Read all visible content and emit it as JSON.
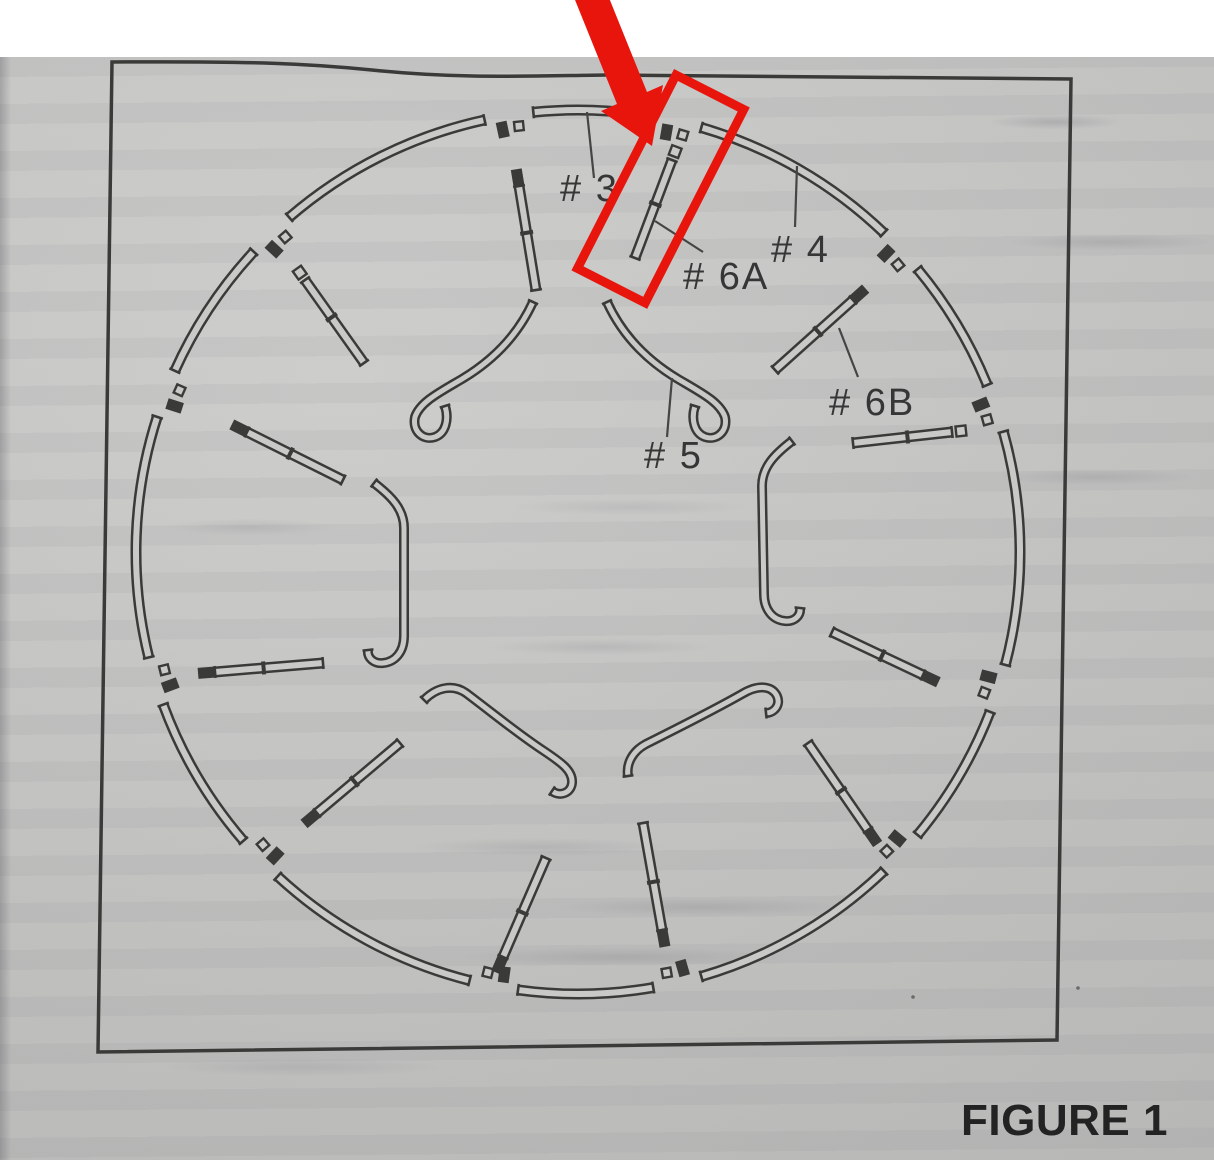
{
  "colors": {
    "paper": "#c9c9c7",
    "ink": "#3a3a38",
    "label": "#363636",
    "leader": "#454545",
    "caption": "#232323",
    "red": "#e8150d",
    "page_bg": "#c7c7c5",
    "scan_bg": "#ffffff"
  },
  "scan": {
    "white_band_height": 57
  },
  "figure": {
    "caption": "FIGURE 1",
    "frame": {
      "d": "M112,62 C260,61 312,64 372,70 C456,79 526,76 606,75 L1071,79 L1057,1040 L98,1052 Z"
    },
    "ring": {
      "cx": 578,
      "cy": 552,
      "r": 442,
      "band": 11,
      "gap_margin": 3.2,
      "gap_angles": [
        -9,
        13,
        47,
        71,
        108,
        133,
        167,
        191,
        226,
        253,
        291,
        316
      ]
    },
    "rods": [
      {
        "x1": 519,
        "y1": 186,
        "x2": 536,
        "y2": 290,
        "cap": "dark"
      },
      {
        "x1": 672,
        "y1": 160,
        "x2": 635,
        "y2": 258,
        "cap": "open"
      },
      {
        "x1": 853,
        "y1": 300,
        "x2": 775,
        "y2": 370,
        "cap": "dark"
      },
      {
        "x1": 952,
        "y1": 432,
        "x2": 853,
        "y2": 443,
        "cap": "open"
      },
      {
        "x1": 923,
        "y1": 675,
        "x2": 832,
        "y2": 632,
        "cap": "dark"
      },
      {
        "x1": 868,
        "y1": 830,
        "x2": 808,
        "y2": 743,
        "cap": "dark"
      },
      {
        "x1": 662,
        "y1": 930,
        "x2": 643,
        "y2": 823,
        "cap": "dark"
      },
      {
        "x1": 503,
        "y1": 957,
        "x2": 546,
        "y2": 858,
        "cap": "dark"
      },
      {
        "x1": 317,
        "y1": 813,
        "x2": 400,
        "y2": 743,
        "cap": "dark"
      },
      {
        "x1": 215,
        "y1": 672,
        "x2": 323,
        "y2": 663,
        "cap": "dark"
      },
      {
        "x1": 247,
        "y1": 432,
        "x2": 343,
        "y2": 480,
        "cap": "dark"
      },
      {
        "x1": 305,
        "y1": 280,
        "x2": 364,
        "y2": 363,
        "cap": "open"
      }
    ],
    "hooks": [
      {
        "d": "M533,302 C517,337 492,361 462,379 C440,392 420,402 415,417 C412,431 423,441 435,437 C446,433 449,419 445,406",
        "caps": [
          [
            533,
            302,
            -16,
            35
          ],
          [
            445,
            406,
            -4,
            -13
          ]
        ]
      },
      {
        "d": "M607,302 C623,337 648,361 678,379 C700,392 720,402 725,417 C728,431 717,441 705,437 C694,433 691,419 695,406",
        "caps": [
          [
            607,
            302,
            16,
            35
          ],
          [
            695,
            406,
            4,
            -13
          ]
        ]
      },
      {
        "d": "M374,483 C391,496 404,509 404,528 L404,636 C404,652 395,662 383,663 C374,664 367,658 368,650",
        "caps": [
          [
            374,
            483,
            17,
            13
          ],
          [
            368,
            650,
            -1,
            -9
          ]
        ]
      },
      {
        "d": "M792,441 C775,454 762,467 762,486 L764,594 C764,610 773,620 785,621 C794,622 801,616 800,608",
        "caps": [
          [
            792,
            441,
            -17,
            13
          ],
          [
            800,
            608,
            1,
            -9
          ]
        ]
      },
      {
        "d": "M424,700 C437,687 453,684 466,693 C494,714 518,734 544,751 C562,763 573,771 572,783 C571,793 560,797 552,791",
        "caps": [
          [
            424,
            700,
            13,
            -13
          ],
          [
            552,
            791,
            -9,
            -6
          ]
        ]
      },
      {
        "d": "M628,776 C626,763 633,751 646,744 C678,728 712,711 742,694 C759,684 772,686 777,696 C781,705 774,713 766,713",
        "caps": [
          [
            628,
            776,
            -2,
            -13
          ],
          [
            766,
            713,
            -9,
            1
          ]
        ]
      }
    ],
    "labels": [
      {
        "id": "3",
        "text": "# 3",
        "x": 560,
        "y": 201
      },
      {
        "id": "4",
        "text": "# 4",
        "x": 771,
        "y": 262
      },
      {
        "id": "5",
        "text": "# 5",
        "x": 644,
        "y": 468
      },
      {
        "id": "6A",
        "text": "# 6A",
        "x": 683,
        "y": 289
      },
      {
        "id": "6B",
        "text": "# 6B",
        "x": 829,
        "y": 415
      }
    ],
    "leaders": [
      {
        "x1": 587,
        "y1": 112,
        "x2": 594,
        "y2": 178
      },
      {
        "x1": 797,
        "y1": 166,
        "x2": 795,
        "y2": 227
      },
      {
        "x1": 672,
        "y1": 378,
        "x2": 667,
        "y2": 437
      },
      {
        "x1": 655,
        "y1": 221,
        "x2": 703,
        "y2": 252
      },
      {
        "x1": 839,
        "y1": 328,
        "x2": 858,
        "y2": 377
      }
    ],
    "annotation": {
      "rect": {
        "x": 676,
        "y": 75,
        "width": 76,
        "height": 217,
        "rotate": 27,
        "stroke_width": 9
      },
      "arrow_points": "652,146 663,85 647,92 601,-22 571,-10 617,104 601,111"
    },
    "specks": [
      {
        "x": 913,
        "y": 997
      },
      {
        "x": 1078,
        "y": 988
      }
    ]
  }
}
